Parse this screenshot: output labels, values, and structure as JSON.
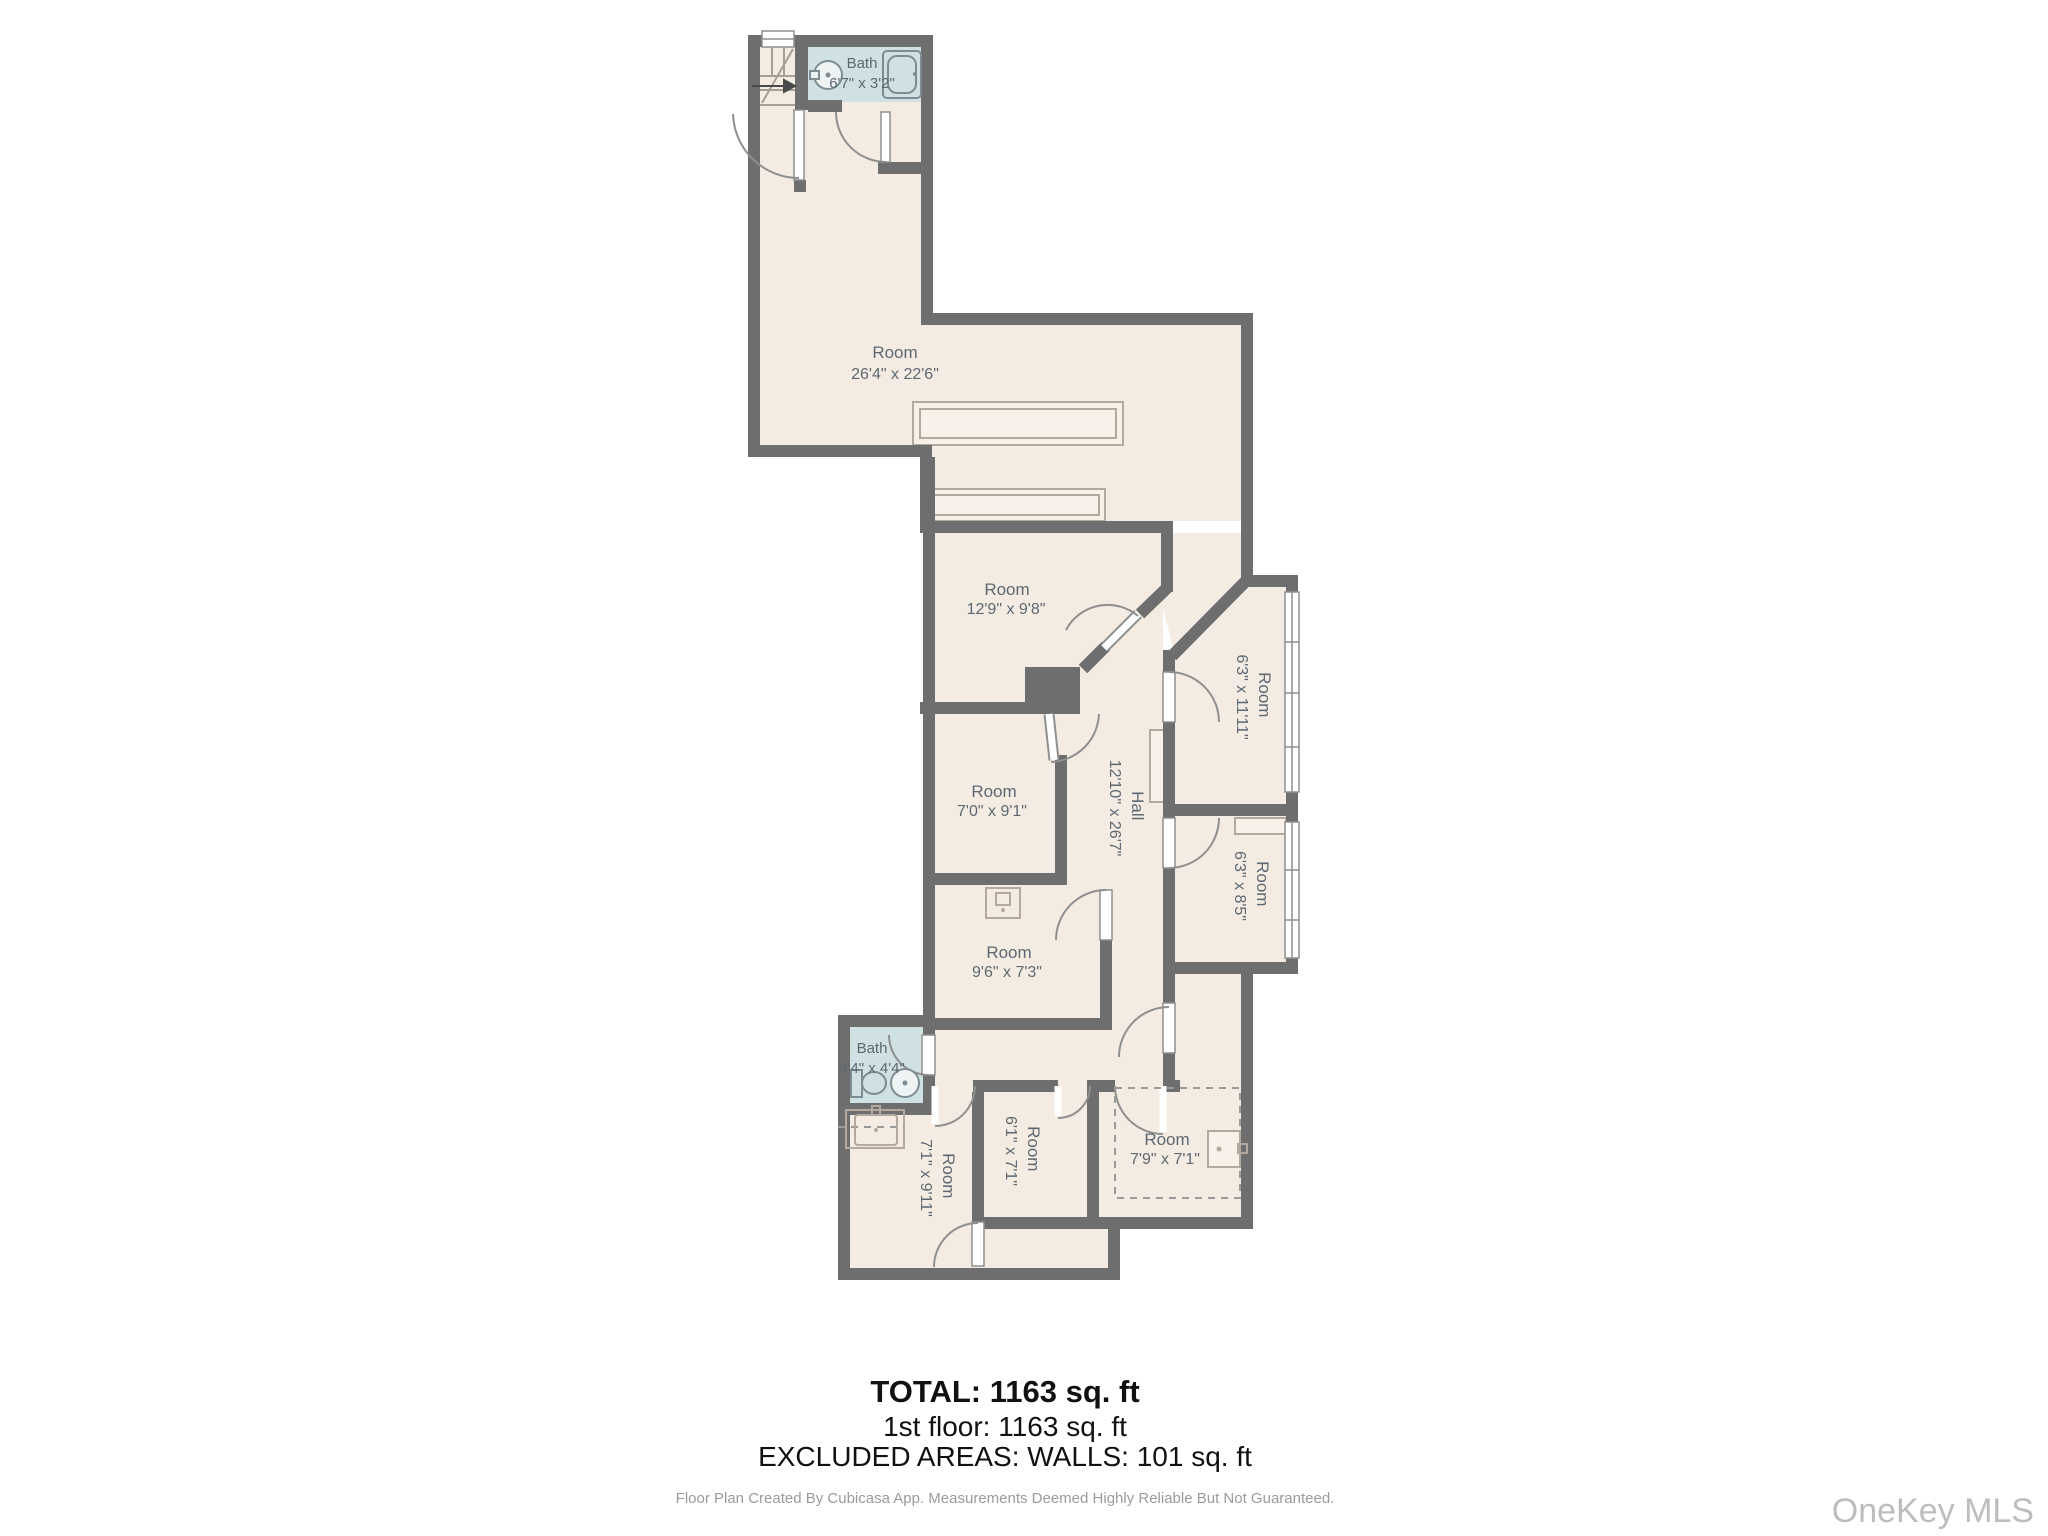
{
  "floor_plan": {
    "rooms": [
      {
        "name": "Bath",
        "dims": "6'7\" x 3'2\""
      },
      {
        "name": "Room",
        "dims": "26'4\" x 22'6\""
      },
      {
        "name": "Room",
        "dims": "12'9\" x 9'8\""
      },
      {
        "name": "Room",
        "dims": "7'0\" x 9'1\""
      },
      {
        "name": "Hall",
        "dims": "12'10\" x 26'7\""
      },
      {
        "name": "Room",
        "dims": "6'3\" x 11'11\""
      },
      {
        "name": "Room",
        "dims": "6'3\" x 8'5\""
      },
      {
        "name": "Room",
        "dims": "9'6\" x 7'3\""
      },
      {
        "name": "Bath",
        "dims": "4'4\" x 4'4\""
      },
      {
        "name": "Room",
        "dims": "7'1\" x 9'11\""
      },
      {
        "name": "Room",
        "dims": "6'1\" x 7'1\""
      },
      {
        "name": "Room",
        "dims": "7'9\" x 7'1\""
      }
    ],
    "summary": {
      "total": "TOTAL: 1163 sq. ft",
      "floor": "1st floor: 1163 sq. ft",
      "excluded": "EXCLUDED AREAS: WALLS: 101 sq. ft"
    },
    "footer": "Floor Plan Created By Cubicasa App. Measurements Deemed Highly Reliable But Not Guaranteed.",
    "watermark": "OneKey MLS",
    "colors": {
      "wall": "#6e6e6e",
      "floor": "#f4ece2",
      "bath": "#cfe1e3",
      "label": "#5d6872",
      "summary_text": "#111111",
      "footer_text": "#9b9b9b",
      "watermark_text": "#bdbdbd"
    }
  }
}
